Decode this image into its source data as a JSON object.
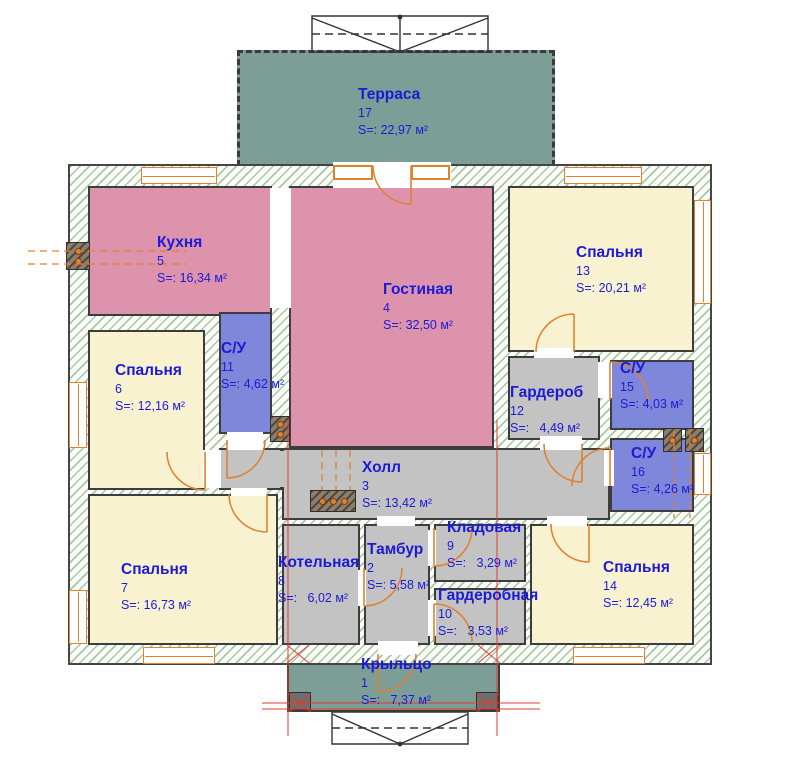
{
  "plan_title": "floor-plan",
  "colors": {
    "room_pink": "#de93ad",
    "room_cream": "#f9f2d0",
    "room_blue": "#7e87d9",
    "room_gray": "#c3c3c4",
    "terrace_green": "#7c9e97",
    "wall_hatch_green": "#609c60",
    "accent_orange": "#e0812f",
    "section_red": "#e03a2f",
    "label_blue": "#1b1bd6"
  },
  "rooms": [
    {
      "id": "terrace",
      "name": "Терраса",
      "number": "17",
      "area": "S=: 22,97 м²"
    },
    {
      "id": "kitchen",
      "name": "Кухня",
      "number": "5",
      "area": "S=: 16,34 м²"
    },
    {
      "id": "living",
      "name": "Гостиная",
      "number": "4",
      "area": "S=: 32,50 м²"
    },
    {
      "id": "bedroom13",
      "name": "Спальня",
      "number": "13",
      "area": "S=: 20,21 м²"
    },
    {
      "id": "bedroom6",
      "name": "Спальня",
      "number": "6",
      "area": "S=: 12,16 м²"
    },
    {
      "id": "su11",
      "name": "С/У",
      "number": "11",
      "area": "S=: 4,62 м²"
    },
    {
      "id": "wardrobe12",
      "name": "Гардероб",
      "number": "12",
      "area": "S=:   4,49 м²"
    },
    {
      "id": "su15",
      "name": "С/У",
      "number": "15",
      "area": "S=: 4,03 м²"
    },
    {
      "id": "su16",
      "name": "С/У",
      "number": "16",
      "area": "S=: 4,26 м²"
    },
    {
      "id": "hall",
      "name": "Холл",
      "number": "3",
      "area": "S=: 13,42 м²"
    },
    {
      "id": "storage9",
      "name": "Кладовая",
      "number": "9",
      "area": "S=:   3,29 м²"
    },
    {
      "id": "dressing10",
      "name": "Гардеробная",
      "number": "10",
      "area": "S=:   3,53 м²"
    },
    {
      "id": "tambur",
      "name": "Тамбур",
      "number": "2",
      "area": "S=: 5,58 м²"
    },
    {
      "id": "boiler",
      "name": "Котельная",
      "number": "8",
      "area": "S=:   6,02 м²"
    },
    {
      "id": "bedroom7",
      "name": "Спальня",
      "number": "7",
      "area": "S=: 16,73 м²"
    },
    {
      "id": "bedroom14",
      "name": "Спальня",
      "number": "14",
      "area": "S=: 12,45 м²"
    },
    {
      "id": "porch",
      "name": "Крыльцо",
      "number": "1",
      "area": "S=:   7,37 м²"
    }
  ]
}
